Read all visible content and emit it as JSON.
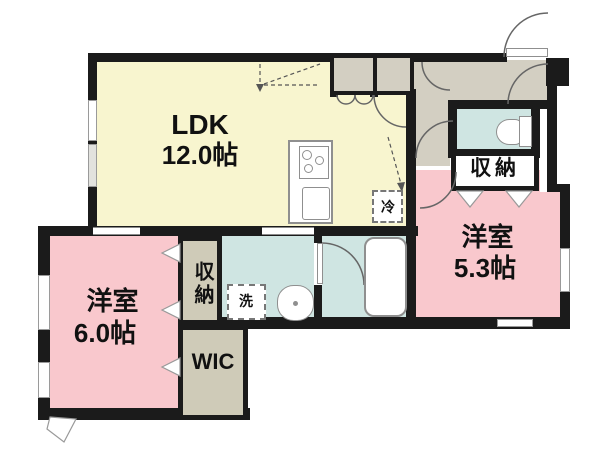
{
  "colors": {
    "wall": "#1b1b1b",
    "ldk": "#f8f5cf",
    "bedroom": "#f9c8cd",
    "wet": "#cfe5e2",
    "hall": "#d3cfc2",
    "closet": "#cfcbb8",
    "line": "#666666"
  },
  "rooms": {
    "ldk": {
      "name": "LDK",
      "size": "12.0帖"
    },
    "bedroom_6": {
      "name": "洋室",
      "size": "6.0帖"
    },
    "bedroom_53": {
      "name": "洋室",
      "size": "5.3帖"
    },
    "storage_left": {
      "label": "収納"
    },
    "storage_right": {
      "label": "収納"
    },
    "wic": {
      "label": "WIC"
    }
  },
  "fixtures": {
    "washer": {
      "label": "洗"
    },
    "fridge": {
      "label": "冷"
    }
  }
}
